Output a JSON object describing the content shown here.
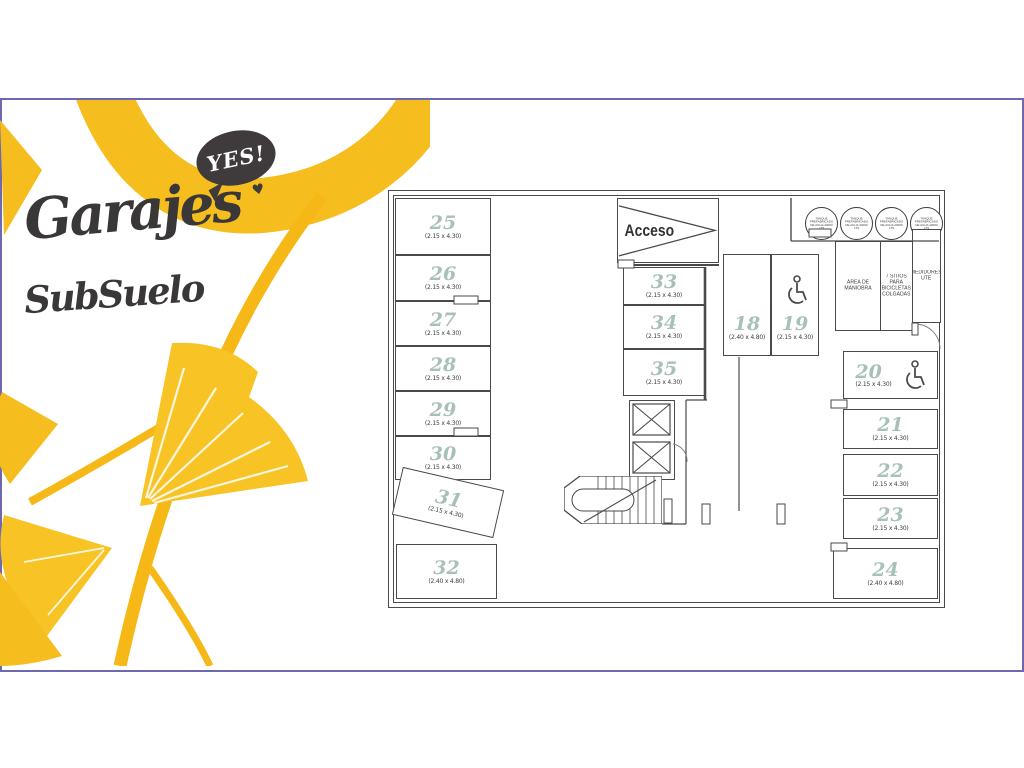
{
  "frame": {
    "border_color": "#6d68b0"
  },
  "branding": {
    "bubble_label": "YES!",
    "heart_glyph": "♥",
    "title": "Garajes",
    "subtitle": "SubSuelo",
    "leaf_color": "#f6bd1e",
    "text_color": "#3a3738"
  },
  "plan": {
    "access_label": "Acceso",
    "tank_label": "TANQUE PREFABRICADO DE AGUA 20000 lts",
    "number_color": "#a8c1b8",
    "line_color": "#4a4a4a",
    "rooms": [
      {
        "label": "ÁREA DE MANIOBRA"
      },
      {
        "label": "7 SITIOS PARA BICICLETAS COLGADAS"
      },
      {
        "label": "MEDIDORES UTE"
      }
    ],
    "stalls": [
      {
        "num": "18",
        "dims": "(2.40 x 4.80)",
        "accessible": false
      },
      {
        "num": "19",
        "dims": "(2.15 x 4.30)",
        "accessible": true
      },
      {
        "num": "20",
        "dims": "(2.15 x 4.30)",
        "accessible": true
      },
      {
        "num": "21",
        "dims": "(2.15 x 4.30)",
        "accessible": false
      },
      {
        "num": "22",
        "dims": "(2.15 x 4.30)",
        "accessible": false
      },
      {
        "num": "23",
        "dims": "(2.15 x 4.30)",
        "accessible": false
      },
      {
        "num": "24",
        "dims": "(2.40 x 4.80)",
        "accessible": false
      },
      {
        "num": "25",
        "dims": "(2.15 x 4.30)",
        "accessible": false
      },
      {
        "num": "26",
        "dims": "(2.15 x 4.30)",
        "accessible": false
      },
      {
        "num": "27",
        "dims": "(2.15 x 4.30)",
        "accessible": false
      },
      {
        "num": "28",
        "dims": "(2.15 x 4.30)",
        "accessible": false
      },
      {
        "num": "29",
        "dims": "(2.15 x 4.30)",
        "accessible": false
      },
      {
        "num": "30",
        "dims": "(2.15 x 4.30)",
        "accessible": false
      },
      {
        "num": "31",
        "dims": "(2.15 x 4.30)",
        "accessible": false
      },
      {
        "num": "32",
        "dims": "(2.40 x 4.80)",
        "accessible": false
      },
      {
        "num": "33",
        "dims": "(2.15 x 4.30)",
        "accessible": false
      },
      {
        "num": "34",
        "dims": "(2.15 x 4.30)",
        "accessible": false
      },
      {
        "num": "35",
        "dims": "(2.15 x 4.30)",
        "accessible": false
      }
    ]
  }
}
